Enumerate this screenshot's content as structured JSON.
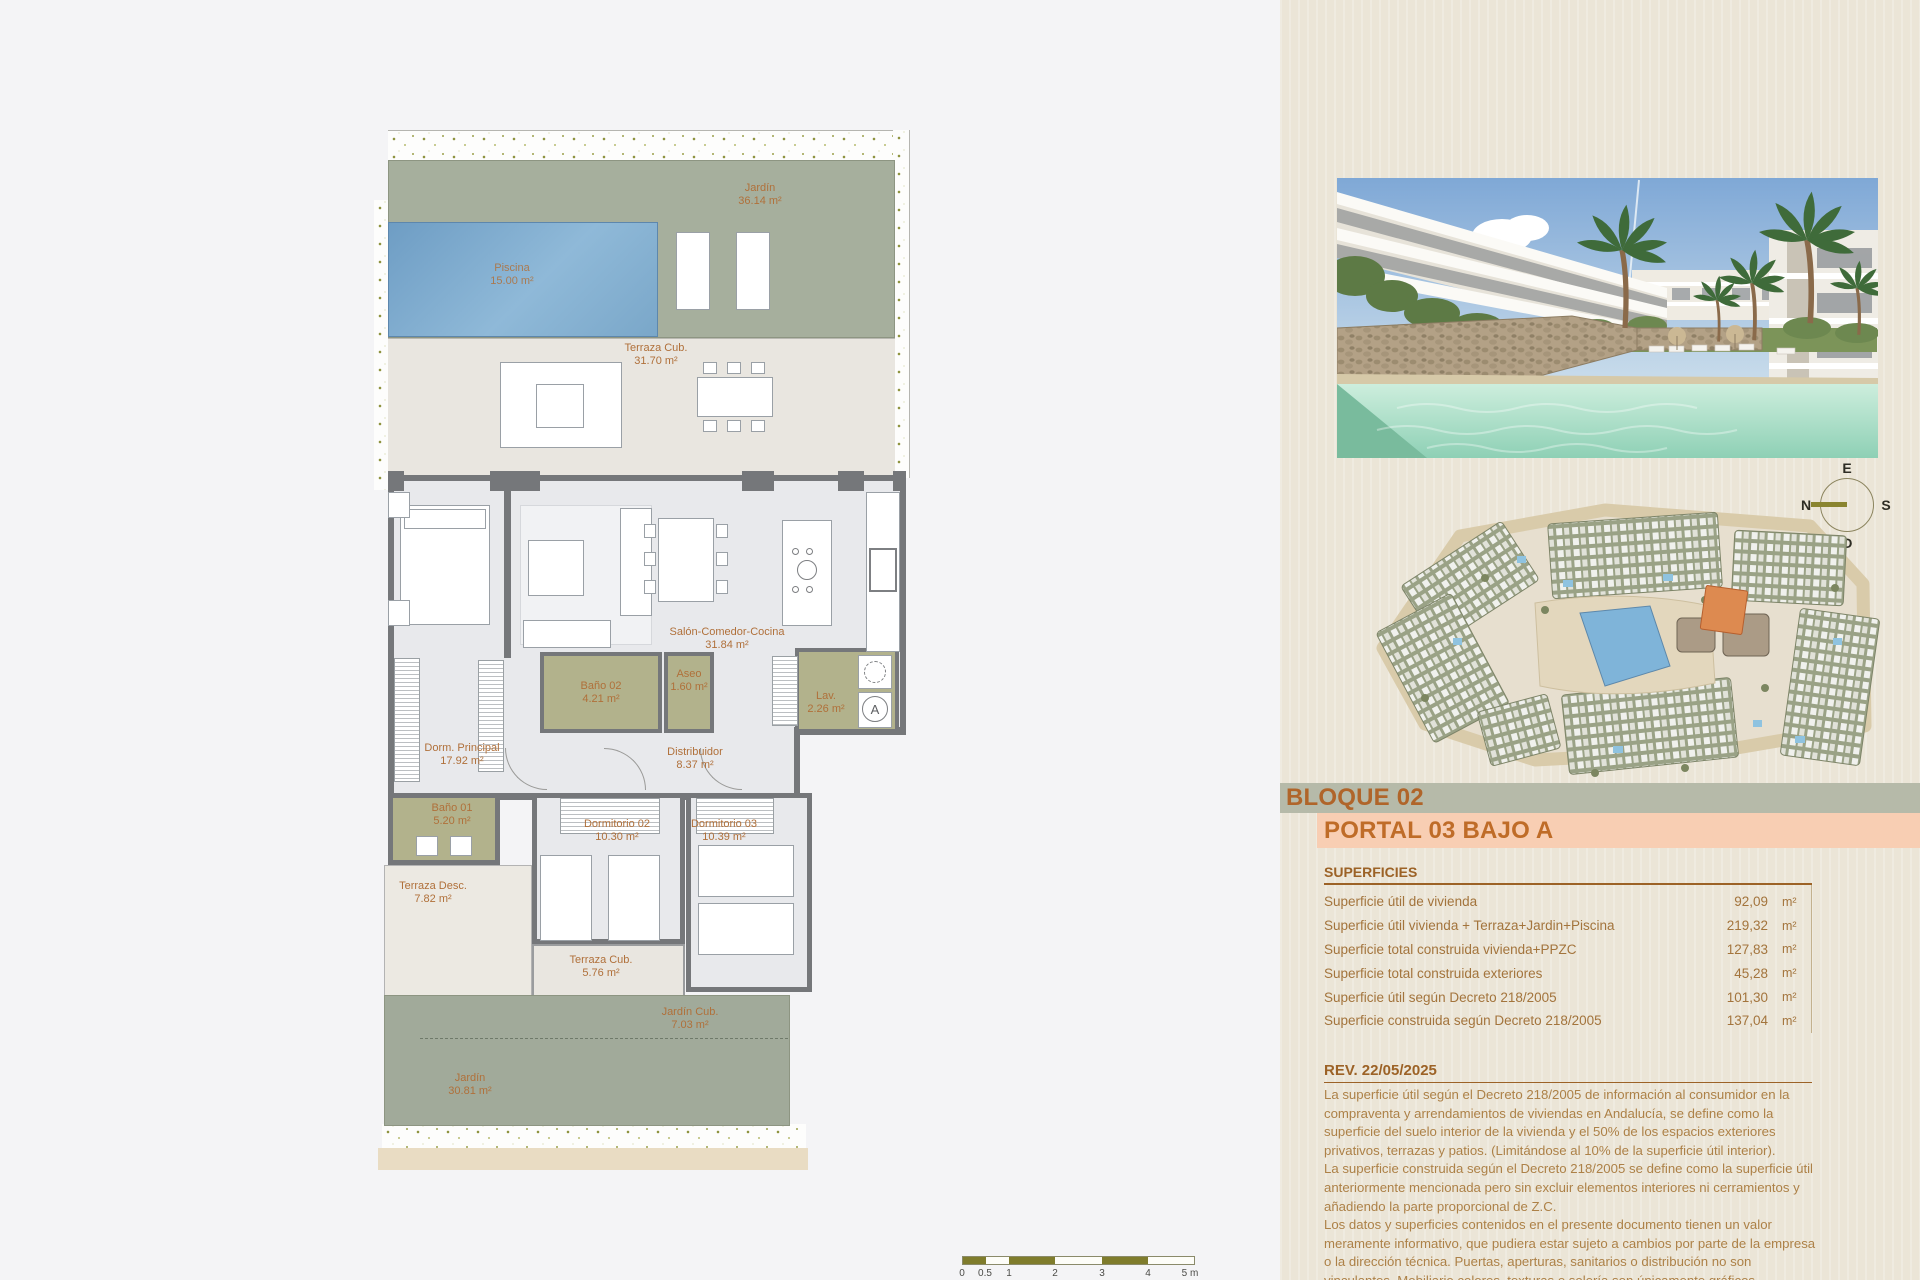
{
  "block": {
    "block_label": "BLOQUE 02",
    "portal_label": "PORTAL 03 BAJO A"
  },
  "superficies": {
    "heading": "SUPERFICIES",
    "rows": [
      {
        "label": "Superficie útil de vivienda",
        "value": "92,09",
        "unit": "m²"
      },
      {
        "label": "Superficie útil vivienda + Terraza+Jardin+Piscina",
        "value": "219,32",
        "unit": "m²"
      },
      {
        "label": "Superficie total construida vivienda+PPZC",
        "value": "127,83",
        "unit": "m²"
      },
      {
        "label": "Superficie total construida exteriores",
        "value": "45,28",
        "unit": "m²"
      },
      {
        "label": "Superficie útil según Decreto 218/2005",
        "value": "101,30",
        "unit": "m²"
      },
      {
        "label": "Superficie construida según Decreto 218/2005",
        "value": "137,04",
        "unit": "m²"
      }
    ]
  },
  "revision": {
    "heading": "REV. 22/05/2025",
    "paragraphs": [
      "La superficie útil según el Decreto 218/2005 de información al consumidor en la compraventa y arrendamientos de viviendas en Andalucía, se define como la superficie del suelo interior de la vivienda y el 50% de los espacios exteriores privativos, terrazas y patios. (Limitándose al 10% de la superficie útil interior).",
      "La superficie construida según el Decreto 218/2005 se define como la superficie útil anteriormente mencionada pero sin excluir elementos interiores ni cerramientos y añadiendo la parte proporcional de Z.C.",
      "Los datos y superficies contenidos en el presente documento tienen un valor meramente informativo, que pudiera estar sujeto a cambios por parte de la empresa o la dirección técnica. Puertas, aperturas, sanitarios o distribución no son vinculantes. Mobiliario,colores, texturas o solería son únicamente gráficos orientativos, por lo que esta documentación no puede ser considerada como una forma de"
    ]
  },
  "floorplan": {
    "rooms": [
      {
        "name": "Jardín",
        "area": "36.14 m²"
      },
      {
        "name": "Piscina",
        "area": "15.00 m²"
      },
      {
        "name": "Terraza Cub.",
        "area": "31.70 m²"
      },
      {
        "name": "Salón-Comedor-Cocina",
        "area": "31.84 m²"
      },
      {
        "name": "Dorm. Principal",
        "area": "17.92 m²"
      },
      {
        "name": "Baño 02",
        "area": "4.21 m²"
      },
      {
        "name": "Aseo",
        "area": "1.60 m²"
      },
      {
        "name": "Lav.",
        "area": "2.26 m²"
      },
      {
        "name": "Distribuidor",
        "area": "8.37 m²"
      },
      {
        "name": "Baño 01",
        "area": "5.20 m²"
      },
      {
        "name": "Terraza Desc.",
        "area": "7.82 m²"
      },
      {
        "name": "Dormitorio 02",
        "area": "10.30 m²"
      },
      {
        "name": "Dormitorio 03",
        "area": "10.39 m²"
      },
      {
        "name": "Terraza Cub.",
        "area": "5.76 m²"
      },
      {
        "name": "Jardín Cub.",
        "area": "7.03 m²"
      },
      {
        "name": "Jardín",
        "area": "30.81 m²"
      }
    ],
    "washer_label": "A",
    "scale_ticks": [
      "0",
      "0.5",
      "1",
      "2",
      "3",
      "4",
      "5 m"
    ]
  },
  "compass": {
    "top": "E",
    "right": "S",
    "bottom": "O",
    "left": "N"
  },
  "colors": {
    "accent": "#b0652a",
    "sage_band": "#b6baa9",
    "peach_band": "#f8ceb3",
    "highlight_unit": "#dd8a50"
  }
}
